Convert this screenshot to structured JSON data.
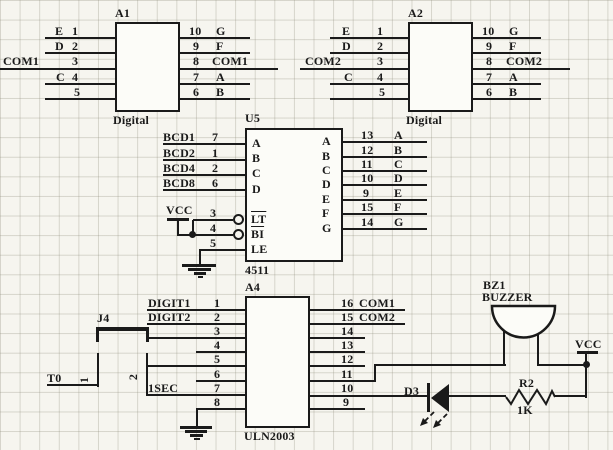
{
  "colors": {
    "line": "#1a1a1a",
    "background": "#f6f5ef",
    "grid": "#8a8876"
  },
  "power": {
    "vcc_left": "VCC",
    "vcc_right": "VCC"
  },
  "nets": {
    "t0": "T0"
  },
  "components": {
    "a1": {
      "ref": "A1",
      "type_label": "Digital",
      "left_pins": [
        {
          "name": "E",
          "num": "1"
        },
        {
          "name": "D",
          "num": "2"
        },
        {
          "name": "COM1",
          "num": "3"
        },
        {
          "name": "C",
          "num": "4"
        },
        {
          "name": "",
          "num": "5"
        }
      ],
      "right_pins": [
        {
          "num": "10",
          "name": "G"
        },
        {
          "num": "9",
          "name": "F"
        },
        {
          "num": "8",
          "name": "COM1"
        },
        {
          "num": "7",
          "name": "A"
        },
        {
          "num": "6",
          "name": "B"
        }
      ]
    },
    "a2": {
      "ref": "A2",
      "type_label": "Digital",
      "left_pins": [
        {
          "name": "E",
          "num": "1"
        },
        {
          "name": "D",
          "num": "2"
        },
        {
          "name": "COM2",
          "num": "3"
        },
        {
          "name": "C",
          "num": "4"
        },
        {
          "name": "",
          "num": "5"
        }
      ],
      "right_pins": [
        {
          "num": "10",
          "name": "G"
        },
        {
          "num": "9",
          "name": "F"
        },
        {
          "num": "8",
          "name": "COM2"
        },
        {
          "num": "7",
          "name": "A"
        },
        {
          "num": "6",
          "name": "B"
        }
      ]
    },
    "u5": {
      "ref": "U5",
      "part": "4511",
      "left_pins": [
        {
          "name": "BCD1",
          "num": "7",
          "inner": "A"
        },
        {
          "name": "BCD2",
          "num": "1",
          "inner": "B"
        },
        {
          "name": "BCD4",
          "num": "2",
          "inner": "C"
        },
        {
          "name": "BCD8",
          "num": "6",
          "inner": "D"
        },
        {
          "name": "",
          "num": "3",
          "inner": "LT"
        },
        {
          "name": "",
          "num": "4",
          "inner": "BI"
        },
        {
          "name": "",
          "num": "5",
          "inner": "LE"
        }
      ],
      "right_pins": [
        {
          "num": "13",
          "name": "A",
          "inner": "A"
        },
        {
          "num": "12",
          "name": "B",
          "inner": "B"
        },
        {
          "num": "11",
          "name": "C",
          "inner": "C"
        },
        {
          "num": "10",
          "name": "D",
          "inner": "D"
        },
        {
          "num": "9",
          "name": "E",
          "inner": "E"
        },
        {
          "num": "15",
          "name": "F",
          "inner": "F"
        },
        {
          "num": "14",
          "name": "G",
          "inner": "G"
        }
      ]
    },
    "a4": {
      "ref": "A4",
      "part": "ULN2003",
      "left_pins": [
        {
          "name": "DIGIT1",
          "num": "1"
        },
        {
          "name": "DIGIT2",
          "num": "2"
        },
        {
          "name": "",
          "num": "3"
        },
        {
          "name": "",
          "num": "4"
        },
        {
          "name": "",
          "num": "5"
        },
        {
          "name": "",
          "num": "6"
        },
        {
          "name": "1SEC",
          "num": "7"
        },
        {
          "name": "",
          "num": "8"
        }
      ],
      "right_pins": [
        {
          "num": "16",
          "name": "COM1"
        },
        {
          "num": "15",
          "name": "COM2"
        },
        {
          "num": "14",
          "name": ""
        },
        {
          "num": "13",
          "name": ""
        },
        {
          "num": "12",
          "name": ""
        },
        {
          "num": "11",
          "name": ""
        },
        {
          "num": "10",
          "name": ""
        },
        {
          "num": "9",
          "name": ""
        }
      ]
    },
    "j4": {
      "ref": "J4",
      "pin1": "1",
      "pin2": "2"
    },
    "bz1": {
      "ref": "BZ1",
      "type_label": "BUZZER"
    },
    "d3": {
      "ref": "D3"
    },
    "r2": {
      "ref": "R2",
      "value": "1K"
    }
  }
}
